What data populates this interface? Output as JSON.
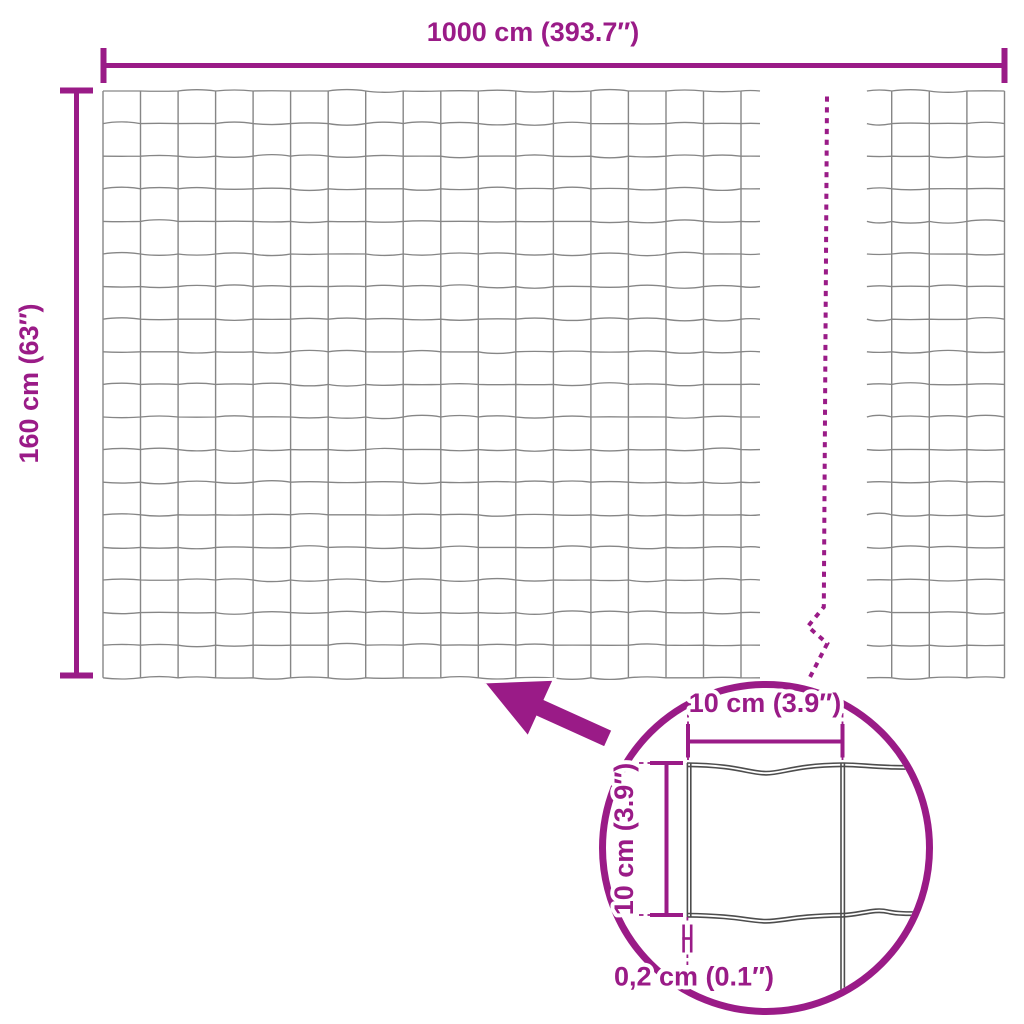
{
  "diagram": {
    "labels": {
      "total_width": "1000 cm (393.7″)",
      "total_height": "160 cm (63″)",
      "detail_cell_width": "10 cm (3.9″)",
      "detail_cell_height": "10 cm (3.9″)",
      "detail_wire_thickness": "0,2 cm (0.1″)"
    },
    "colors": {
      "accent": "#9A1B87",
      "mesh_line": "#868686",
      "detail_line": "#4D4D4D",
      "background": "#FFFFFF"
    }
  }
}
